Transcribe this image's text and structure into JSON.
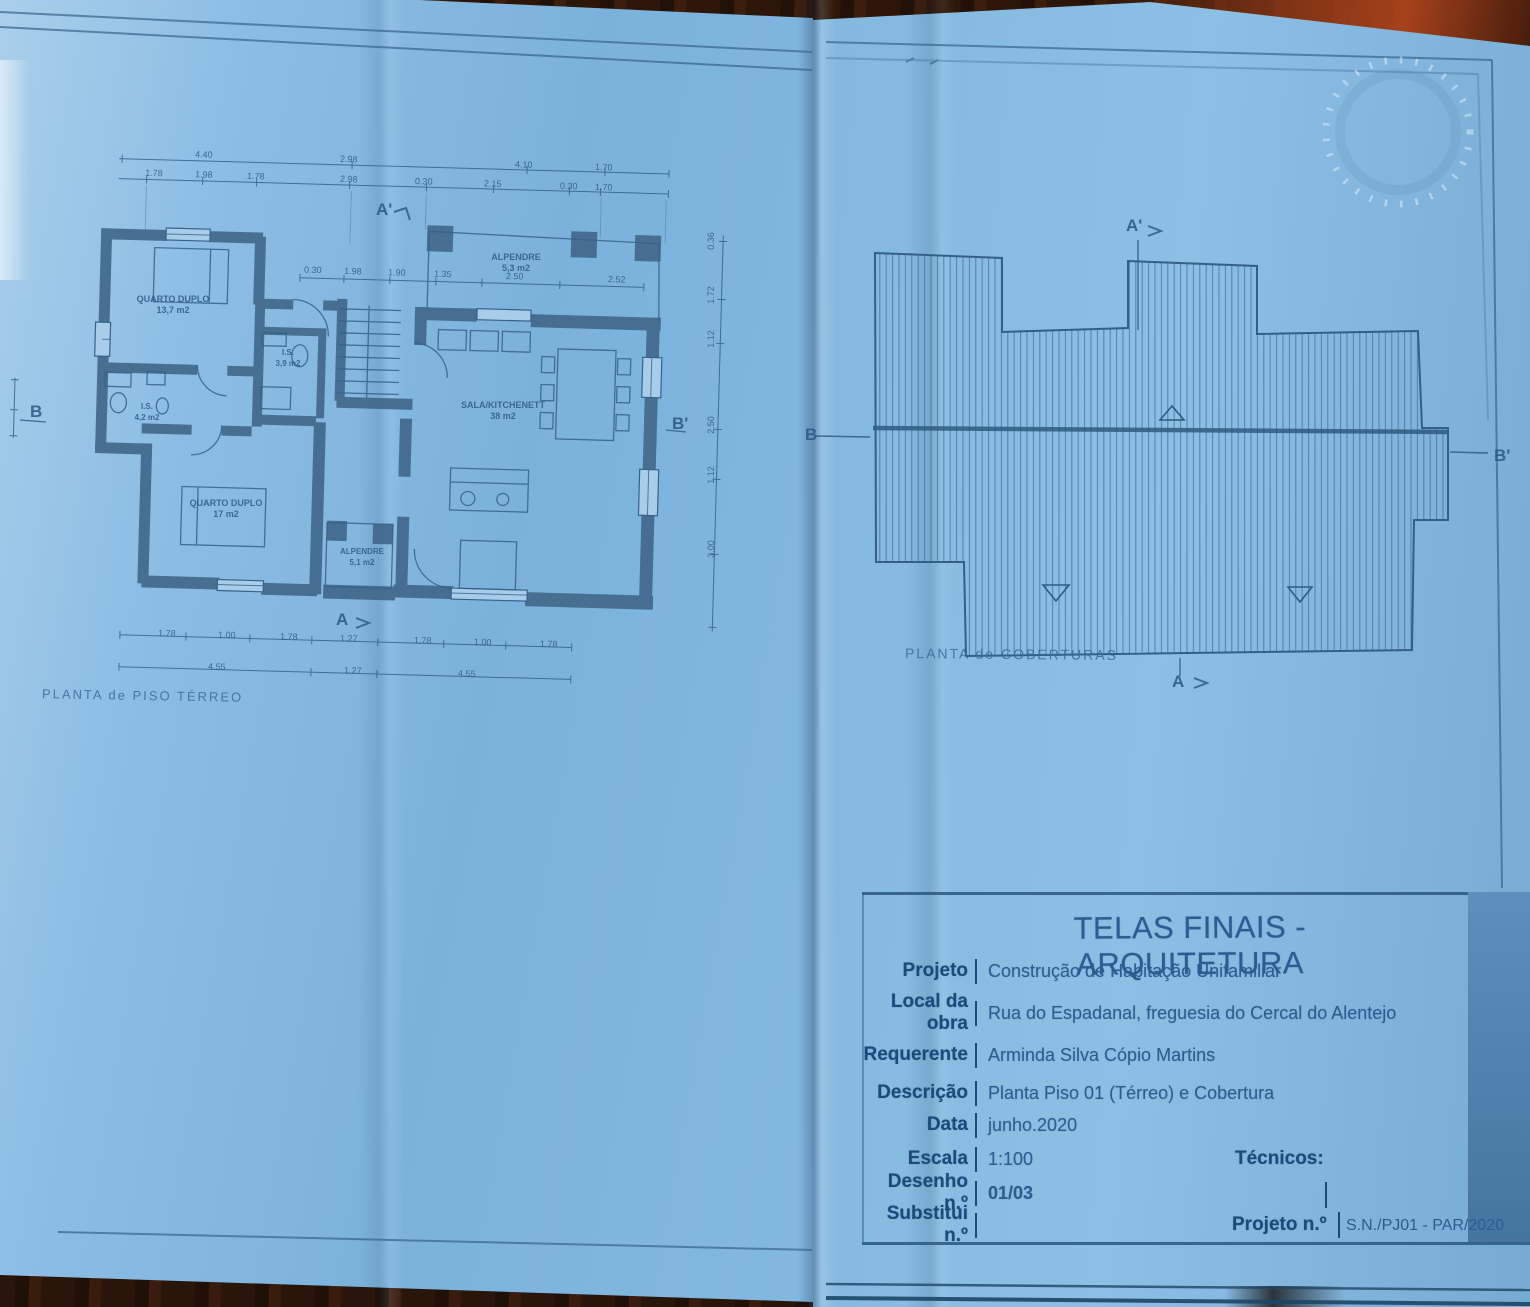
{
  "colors": {
    "paper_blue": "#7fb4dc",
    "ink_blue": "#2e5c84",
    "label_blue": "#1c4a7b",
    "wall_blue": "#40678a",
    "wood_brown": "#33190c"
  },
  "left_sheet": {
    "plan_title": "PLANTA de PISO TÉRREO",
    "markers": {
      "a_prime": "A'",
      "a": "A",
      "b": "B",
      "b_prime": "B'"
    },
    "rooms": {
      "quarto1": {
        "name": "QUARTO DUPLO",
        "area": "13,7 m2"
      },
      "quarto2": {
        "name": "QUARTO DUPLO",
        "area": "17 m2"
      },
      "sala": {
        "name": "SALA/KITCHENETT",
        "area": "38 m2"
      },
      "alpendre_top": {
        "name": "ALPENDRE",
        "area": "5,3 m2"
      },
      "alpendre_bottom": {
        "name": "ALPENDRE",
        "area": "5,1 m2"
      },
      "is1": {
        "name": "I.S.",
        "area": "3,9 m2"
      },
      "is2": {
        "name": "I.S.",
        "area": "4,2 m2"
      }
    },
    "dims": {
      "top1": [
        "4.40",
        "2.98",
        "4.10",
        "1.70"
      ],
      "top2": [
        "1.78",
        "1.98",
        "1.78",
        "2.98",
        "0.30",
        "2.15",
        "0.30",
        "1.70"
      ],
      "inner": [
        "0.30",
        "1.98",
        "1.90",
        "1.35",
        "2.50",
        "2.52"
      ],
      "bottom": [
        "1.78",
        "1.00",
        "1.78",
        "1.27",
        "1.78",
        "1.00",
        "1.78"
      ],
      "bottom_totals": [
        "4.55",
        "1.27",
        "4.55"
      ],
      "right": [
        "0.36",
        "1.72",
        "1.12",
        "2.50",
        "1.12",
        "3.00"
      ]
    }
  },
  "right_sheet": {
    "plan_title": "PLANTA de COBERTURAS",
    "markers": {
      "a_prime": "A'",
      "a": "A",
      "b": "B",
      "b_prime": "B'"
    }
  },
  "title_block": {
    "title": "TELAS FINAIS - ARQUITETURA",
    "rows": [
      {
        "label": "Projeto",
        "value": "Construção de Habitação Unifamiliar"
      },
      {
        "label": "Local da obra",
        "value": "Rua do Espadanal, freguesia do Cercal do Alentejo"
      },
      {
        "label": "Requerente",
        "value": "Arminda Silva Cópio Martins"
      },
      {
        "label": "Descrição",
        "value": "Planta Piso 01 (Térreo) e Cobertura"
      },
      {
        "label": "Data",
        "value": "junho.2020"
      },
      {
        "label": "Escala",
        "value": "1:100"
      },
      {
        "label": "Desenho n.º",
        "value": "01/03"
      },
      {
        "label": "Substitui n.º",
        "value": ""
      }
    ],
    "tecnicos_label": "Técnicos:",
    "projeto_n_label": "Projeto n.º",
    "projeto_n_value": "S.N./PJ01 - PAR/2020"
  }
}
